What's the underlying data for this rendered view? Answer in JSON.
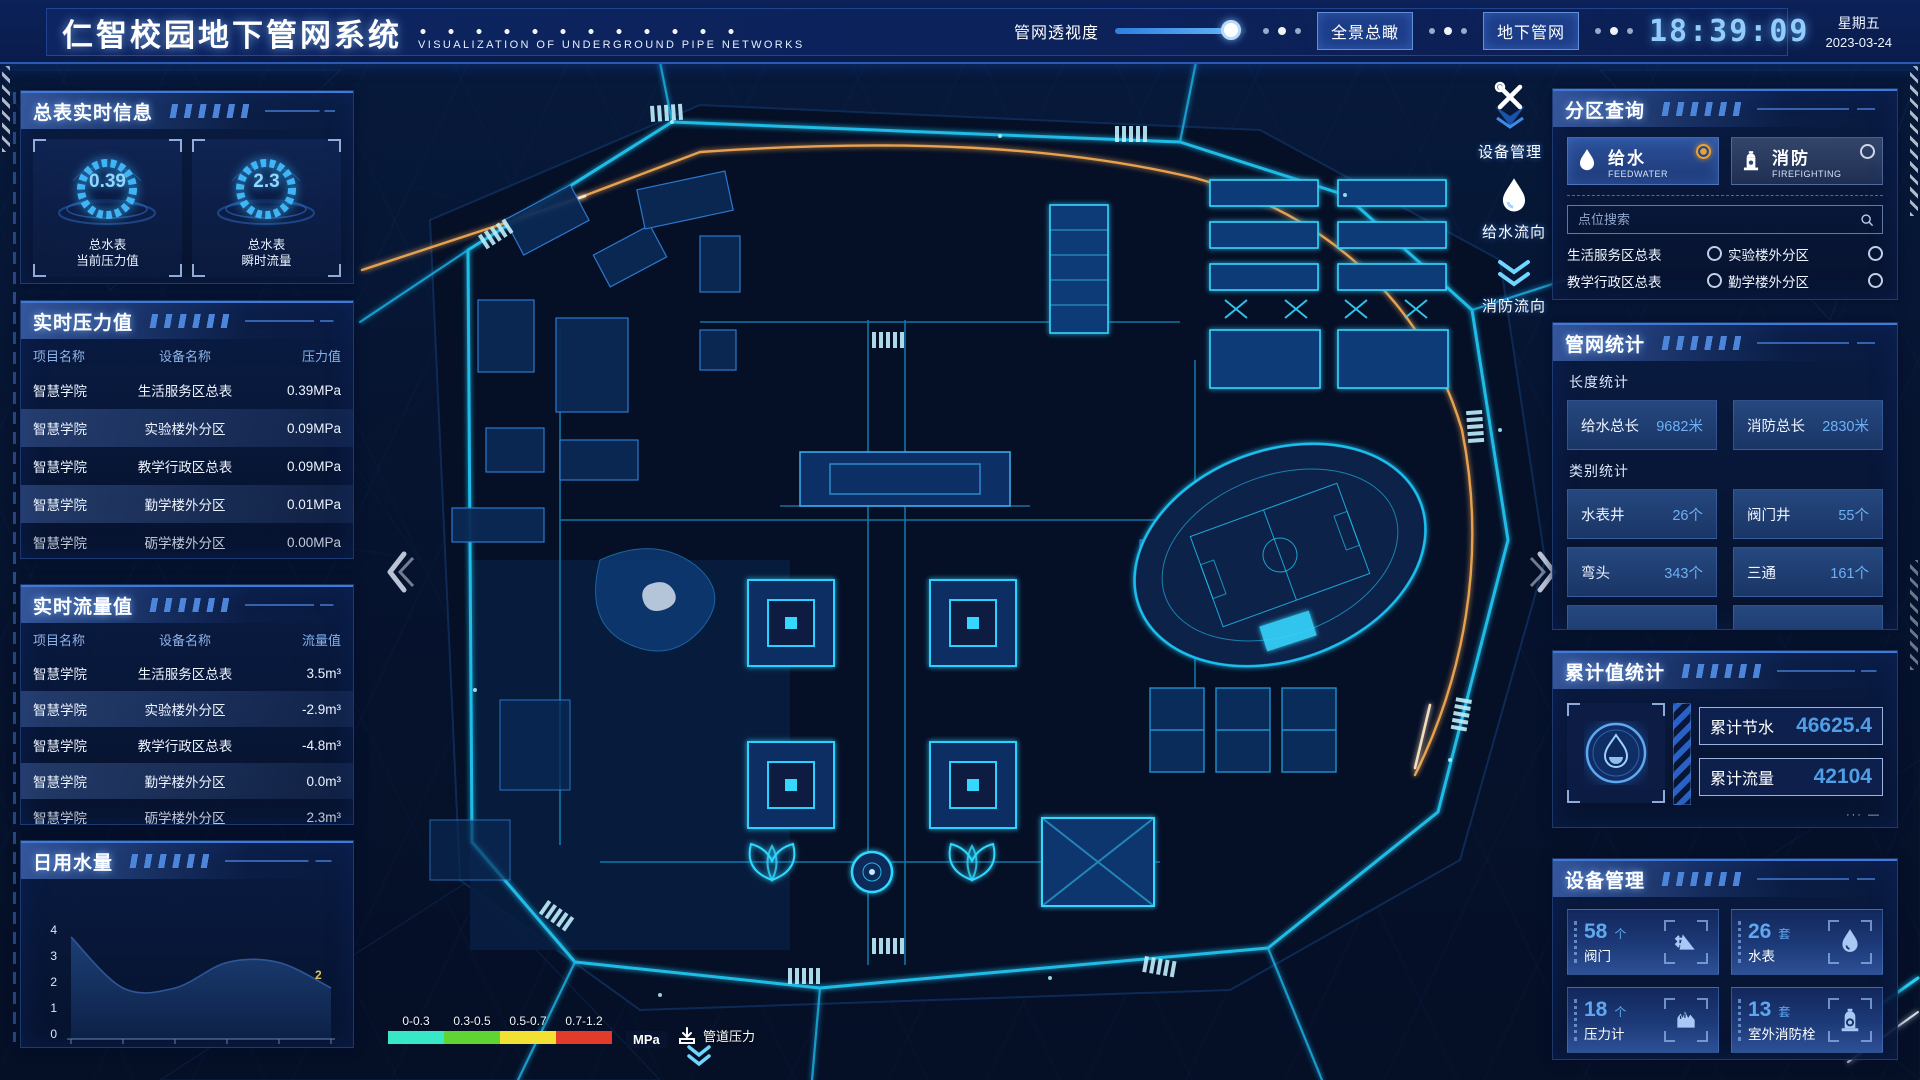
{
  "header": {
    "title": "仁智校园地下管网系统",
    "subtitle": "VISUALIZATION OF UNDERGROUND PIPE NETWORKS",
    "slider_label": "管网透视度",
    "slider_percent": 88,
    "view_buttons": [
      {
        "label": "全景总瞰"
      },
      {
        "label": "地下管网"
      }
    ],
    "clock": {
      "time": "18:39:09",
      "weekday": "星期五",
      "date": "2023-03-24"
    }
  },
  "left": {
    "meter_panel": {
      "title": "总表实时信息",
      "gauges": [
        {
          "value": "0.39",
          "name": "总水表",
          "metric": "当前压力值"
        },
        {
          "value": "2.3",
          "name": "总水表",
          "metric": "瞬时流量"
        }
      ]
    },
    "pressure_panel": {
      "title": "实时压力值",
      "columns": [
        "项目名称",
        "设备名称",
        "压力值"
      ],
      "rows": [
        {
          "project": "智慧学院",
          "device": "生活服务区总表",
          "value": "0.39MPa"
        },
        {
          "project": "智慧学院",
          "device": "实验楼外分区",
          "value": "0.09MPa"
        },
        {
          "project": "智慧学院",
          "device": "教学行政区总表",
          "value": "0.09MPa"
        },
        {
          "project": "智慧学院",
          "device": "勤学楼外分区",
          "value": "0.01MPa"
        },
        {
          "project": "智慧学院",
          "device": "砺学楼外分区",
          "value": "0.00MPa"
        }
      ]
    },
    "flow_panel": {
      "title": "实时流量值",
      "columns": [
        "项目名称",
        "设备名称",
        "流量值"
      ],
      "rows": [
        {
          "project": "智慧学院",
          "device": "生活服务区总表",
          "value": "3.5m³"
        },
        {
          "project": "智慧学院",
          "device": "实验楼外分区",
          "value": "-2.9m³"
        },
        {
          "project": "智慧学院",
          "device": "教学行政区总表",
          "value": "-4.8m³"
        },
        {
          "project": "智慧学院",
          "device": "勤学楼外分区",
          "value": "0.0m³"
        },
        {
          "project": "智慧学院",
          "device": "砺学楼外分区",
          "value": "2.3m³"
        }
      ]
    },
    "daily_panel": {
      "title": "日用水量"
    }
  },
  "chart_data": {
    "type": "area",
    "title": "日用水量",
    "x": [
      "13:16",
      "13:17",
      "13:17",
      "13:22",
      "13:22",
      "13:23"
    ],
    "values": [
      4,
      2,
      2,
      3,
      3,
      2
    ],
    "yticks": [
      "4",
      "3",
      "2",
      "1",
      "0"
    ],
    "ylim": [
      0,
      4
    ],
    "grid": false,
    "last_value_label": "2"
  },
  "map": {
    "side_tools": [
      {
        "label": "设备管理",
        "icon": "tools-icon"
      },
      {
        "label": "给水流向",
        "icon": "waterdrop-icon"
      },
      {
        "label": "消防流向",
        "icon": "flow-arrows-icon"
      }
    ],
    "legend": {
      "ranges": [
        "0-0.3",
        "0.3-0.5",
        "0.5-0.7",
        "0.7-1.2"
      ],
      "colors": [
        "#38e7c6",
        "#5fd433",
        "#f2e033",
        "#e23b2a"
      ],
      "unit": "MPa",
      "label": "管道压力"
    }
  },
  "right": {
    "zone_panel": {
      "title": "分区查询",
      "tabs": [
        {
          "label": "给水",
          "sub": "FEEDWATER",
          "selected": true
        },
        {
          "label": "消防",
          "sub": "FIREFIGHTING",
          "selected": false
        }
      ],
      "search_placeholder": "点位搜索",
      "items": [
        "生活服务区总表",
        "实验楼外分区",
        "教学行政区总表",
        "勤学楼外分区",
        "砺学楼外分区",
        "宿舍区泵房"
      ]
    },
    "network_panel": {
      "title": "管网统计",
      "length_title": "长度统计",
      "length_stats": [
        {
          "label": "给水总长",
          "value": "9682米"
        },
        {
          "label": "消防总长",
          "value": "2830米"
        }
      ],
      "category_title": "类别统计",
      "category_stats": [
        {
          "label": "水表井",
          "value": "26个"
        },
        {
          "label": "阀门井",
          "value": "55个"
        },
        {
          "label": "弯头",
          "value": "343个"
        },
        {
          "label": "三通",
          "value": "161个"
        }
      ]
    },
    "cumulative_panel": {
      "title": "累计值统计",
      "items": [
        {
          "label": "累计节水",
          "value": "46625.4"
        },
        {
          "label": "累计流量",
          "value": "42104"
        }
      ]
    },
    "device_panel": {
      "title": "设备管理",
      "cards": [
        {
          "count": "58",
          "unit": "个",
          "label": "阀门",
          "icon": "valve-icon"
        },
        {
          "count": "26",
          "unit": "套",
          "label": "水表",
          "icon": "water-meter-icon"
        },
        {
          "count": "18",
          "unit": "个",
          "label": "压力计",
          "icon": "pressure-gauge-icon"
        },
        {
          "count": "13",
          "unit": "套",
          "label": "室外消防栓",
          "icon": "hydrant-icon"
        }
      ]
    }
  },
  "colors": {
    "accent_cyan": "#29c8f0",
    "accent_orange": "#ffb257",
    "value_blue": "#5fa8f0",
    "time_blue": "#93cdfc",
    "radio_selected": "#f0a32a"
  }
}
